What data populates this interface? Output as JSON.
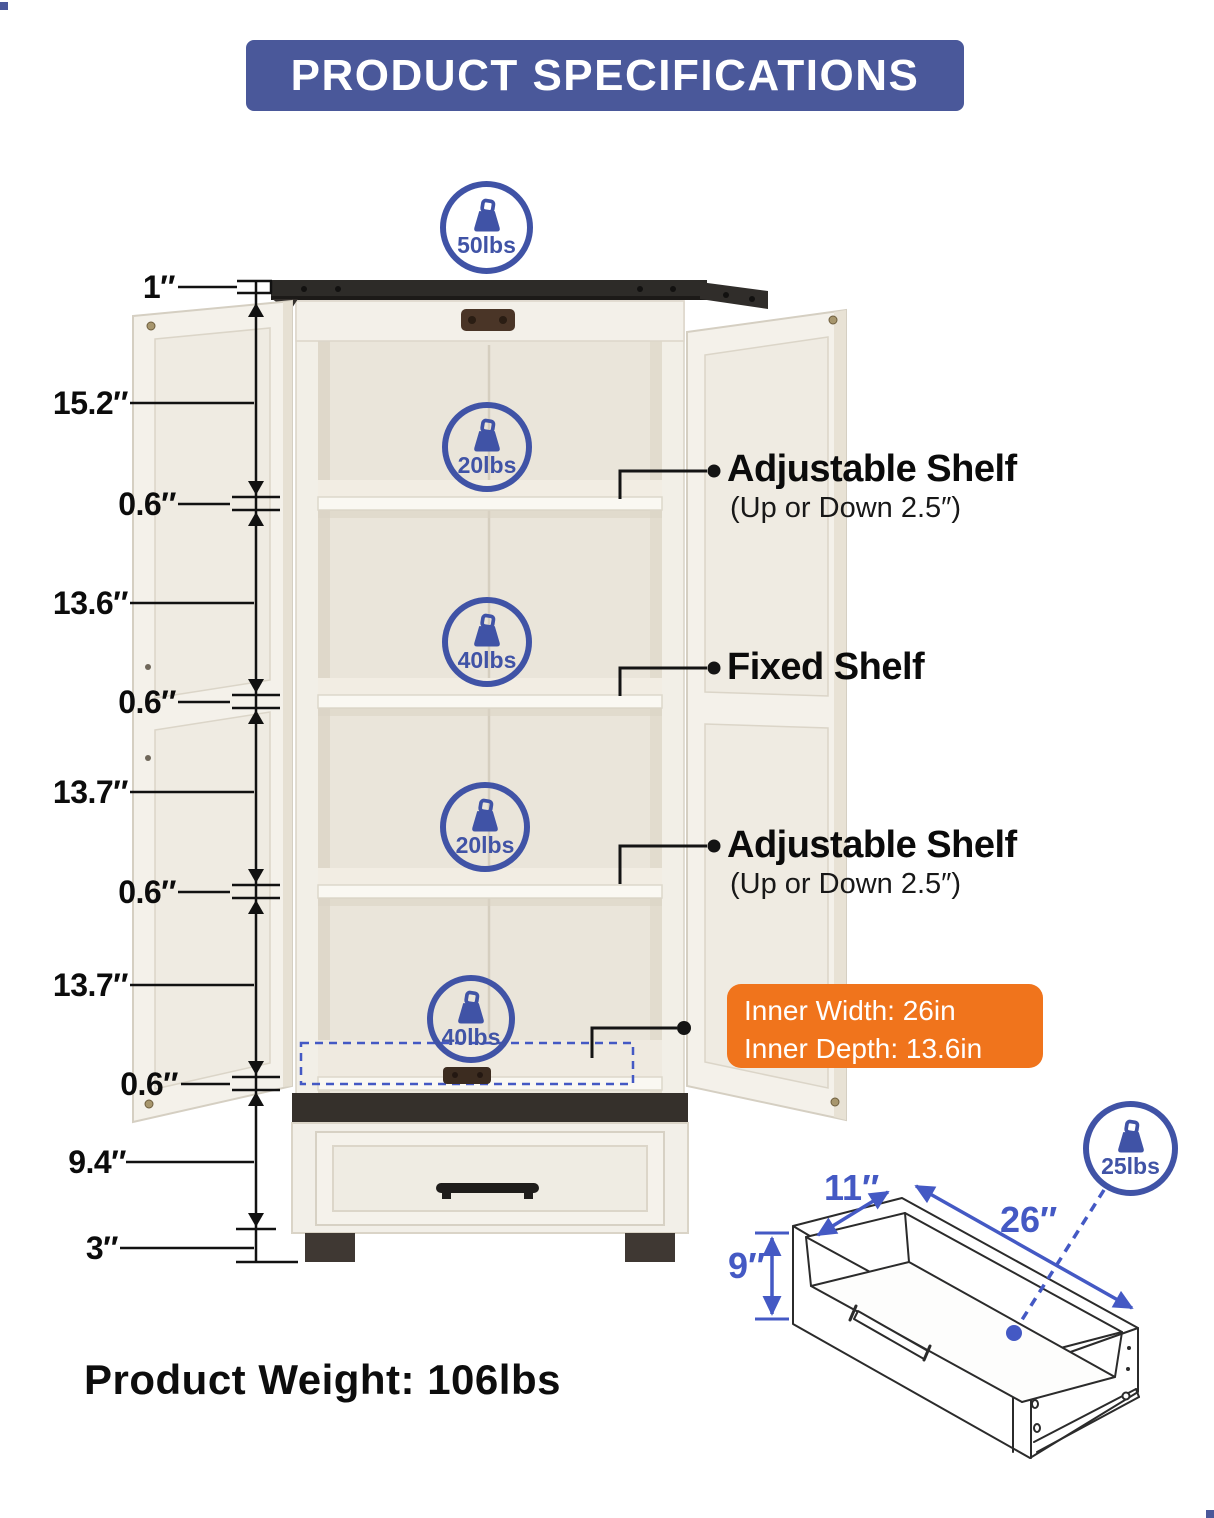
{
  "title": {
    "text": "PRODUCT SPECIFICATIONS"
  },
  "colors": {
    "banner_blue": "#4A589A",
    "icon_blue": "#4053A6",
    "drawer_dim_blue": "#4459C4",
    "accent_orange": "#F0741C",
    "text_black": "#0D0D0D"
  },
  "weight_capacities": {
    "cabinet_top": "50lbs",
    "shelf_1": "20lbs",
    "shelf_2": "40lbs",
    "shelf_3": "20lbs",
    "shelf_4": "40lbs",
    "drawer": "25lbs"
  },
  "height_dimensions": {
    "top_panel": "1″",
    "section_1": "15.2″",
    "shelf_thickness_1": "0.6″",
    "section_2": "13.6″",
    "shelf_thickness_2": "0.6″",
    "section_3": "13.7″",
    "shelf_thickness_3": "0.6″",
    "section_4": "13.7″",
    "bottom_panel": "0.6″",
    "drawer_section": "9.4″",
    "legs": "3″"
  },
  "shelf_callouts": {
    "adjustable_top": {
      "title": "Adjustable Shelf",
      "subtitle": "(Up or Down 2.5″)"
    },
    "fixed": {
      "title": "Fixed Shelf"
    },
    "adjustable_bottom": {
      "title": "Adjustable Shelf",
      "subtitle": "(Up or Down 2.5″)"
    }
  },
  "inner_dimensions": {
    "width": "Inner Width: 26in",
    "depth": "Inner Depth: 13.6in"
  },
  "drawer_dimensions": {
    "depth": "11″",
    "width": "26″",
    "height": "9″"
  },
  "product_weight": "Product Weight: 106lbs"
}
